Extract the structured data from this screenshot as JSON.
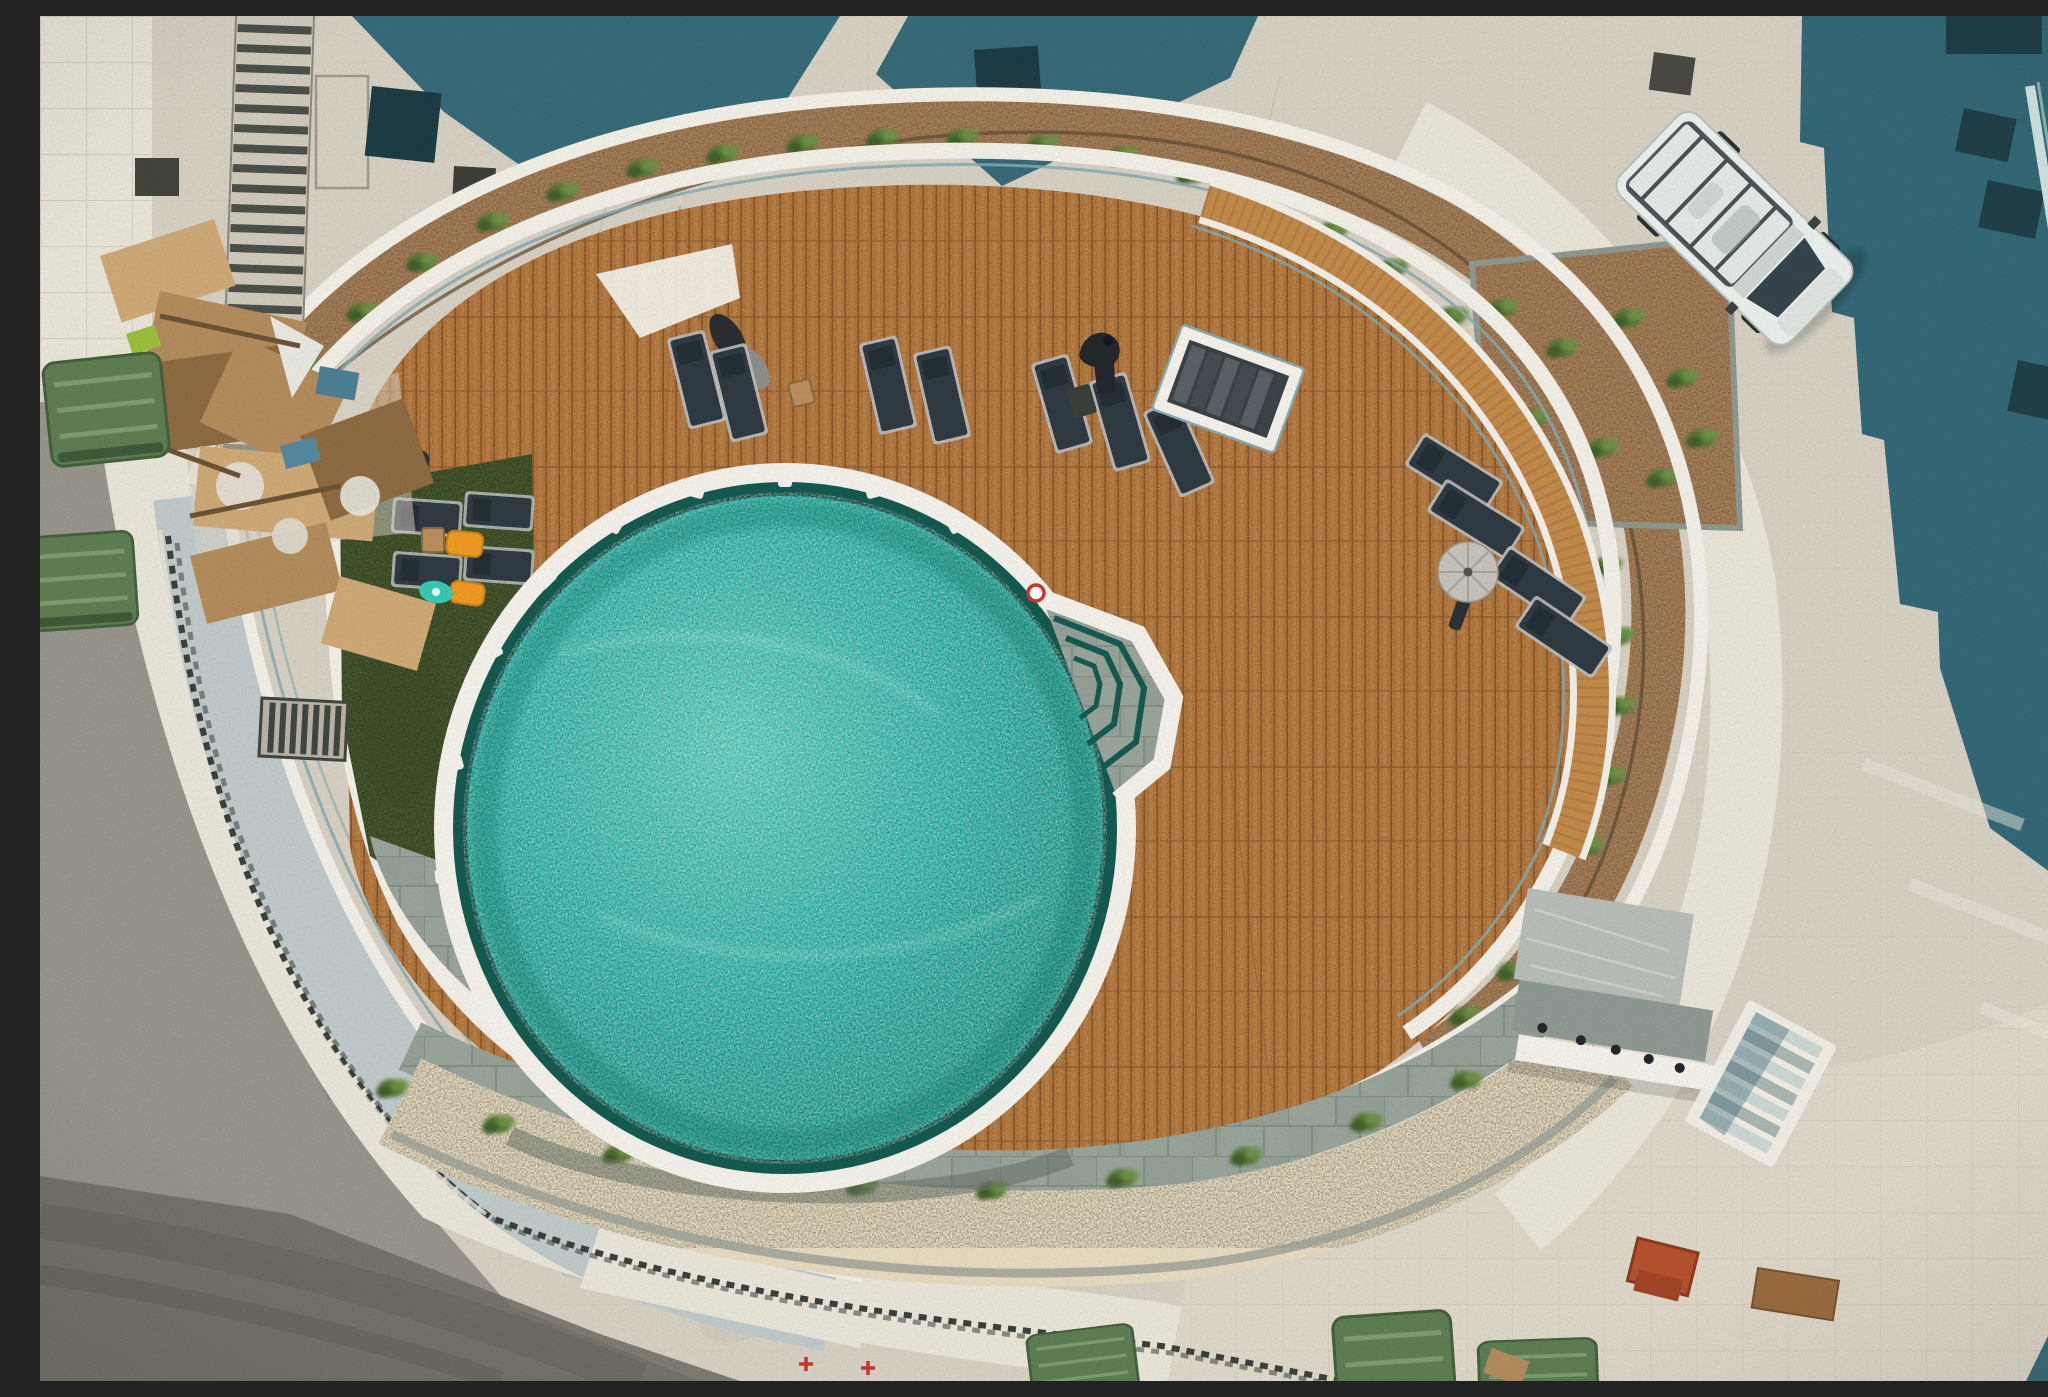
{
  "image": {
    "width": 2048,
    "height": 1365,
    "kind": "aerial-drone-photo"
  },
  "scene": {
    "description": "Top-down aerial photograph of a new oval rooftop swimming pool terrace: turquoise pool with corner entry steps, curved hardwood deck with dark sun loungers, artificial-turf lounge corner with orange pool floats, curved planter beds, perimeter ramp and railings, a parked white panel van, construction debris pile, green waste containers and surrounding concrete plaza with building shadows."
  },
  "palette": {
    "concrete": "#d6d0c3",
    "concrete_light": "#e9e4d8",
    "concrete_mid": "#ddd7c9",
    "asphalt": "#97948b",
    "asphalt_dark": "#6e6c64",
    "shadow_teal": "#2b6272",
    "deck_wood": "#b5793f",
    "deck_wood_dark": "#8a5a2e",
    "deck_wood_light": "#cda371",
    "bench_wood": "#c28a4b",
    "planter_soil": "#a8815a",
    "plant_green": "#567536",
    "plant_green_dark": "#3f5e2c",
    "plant_green_light": "#6f9346",
    "grass": "#46592f",
    "stone": "#99a49b",
    "stone_dark": "#7e8b80",
    "stone_shadow": "#5f6b62",
    "gravel": "#e5dabf",
    "pool_water": "#25b2a6",
    "pool_water_light": "#7fded2",
    "pool_water_dark": "#0f8276",
    "pool_ring": "#155a50",
    "rim_white": "#f2f0e9",
    "wall_white": "#f1eee6",
    "ramp": "#bfc9ca",
    "glass_teal": "#86a9ae",
    "lounger": "#2f3a42",
    "lounger_frame": "#b9bdbe",
    "umbrella_gray": "#c6c2b9",
    "float_orange": "#eb9a22",
    "float_teal": "#38c9b6",
    "van_white": "#eaefec",
    "van_dark": "#37444d",
    "dumpster_green": "#5e7d52",
    "cardboard": "#b38c5d",
    "cardboard_light": "#cda976",
    "cardboard_dark": "#8d6b42",
    "fence_dark": "#3c413c",
    "red_marking": "#c23b2e"
  },
  "inventory": {
    "swimming_pool": 1,
    "pool_entry_steps": 1,
    "lifering_marker": 1,
    "sun_loungers_on_deck": 12,
    "sun_loungers_on_lawn": 4,
    "closed_parasols": 3,
    "open_parasol": 1,
    "side_tables": 4,
    "horse_sculpture": 1,
    "shower_platform": 1,
    "stair_flights": 3,
    "planter_beds": 3,
    "artificial_turf_area": 1,
    "pool_floats": 3,
    "white_van": 1,
    "waste_containers": 5,
    "debris_pile": 1,
    "pergola": 1
  }
}
